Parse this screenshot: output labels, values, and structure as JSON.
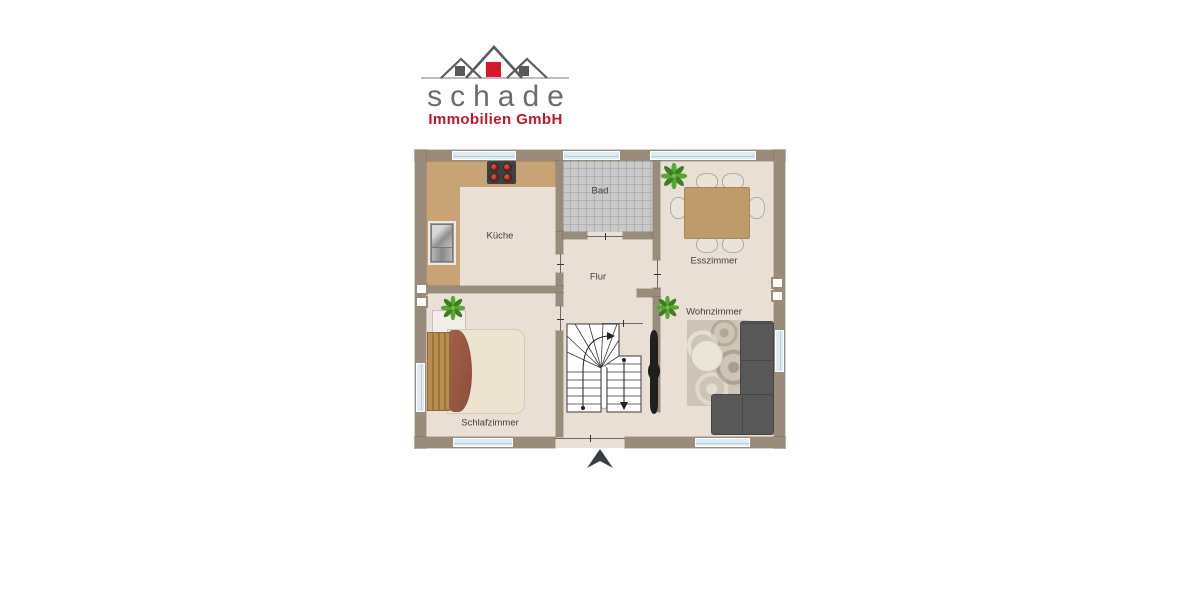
{
  "logo": {
    "brand": "schade",
    "subtitle": "Immobilien GmbH",
    "colors": {
      "brand_text": "#6b6c6f",
      "subtitle_text": "#c2172b",
      "roof_outline": "#5b5c5e",
      "red_square": "#d6182f",
      "gray_square": "#58595b"
    }
  },
  "plan": {
    "rooms": [
      {
        "id": "kueche",
        "label": "Küche",
        "furniture": [
          "kitchen-counter",
          "stove",
          "sink"
        ]
      },
      {
        "id": "bad",
        "label": "Bad",
        "furniture": [
          "tile-floor"
        ]
      },
      {
        "id": "esszimmer",
        "label": "Esszimmer",
        "furniture": [
          "dining-table",
          "six-chairs",
          "plant"
        ]
      },
      {
        "id": "flur",
        "label": "Flur",
        "furniture": []
      },
      {
        "id": "wohnzimmer",
        "label": "Wohnzimmer",
        "furniture": [
          "corner-sofa",
          "round-table",
          "rug",
          "plant",
          "dark-decor"
        ]
      },
      {
        "id": "schlafzimmer",
        "label": "Schlafzimmer",
        "furniture": [
          "double-bed",
          "dresser",
          "plant"
        ]
      }
    ],
    "features": [
      "u-shaped-staircase",
      "entrance-arrow",
      "chimney-blocks",
      "windows",
      "door-openings"
    ],
    "colors": {
      "wall": "#9a8c7b",
      "floor": "#eadfd5",
      "bathroom_tile": "#c9c9c9",
      "counter": "#c8a376",
      "window_glass": "#dcecf2",
      "sofa": "#585858",
      "dining_table": "#bf9a6a",
      "blanket": "#9a5a41",
      "plant_green": "#55a02e",
      "arrow": "#3a3d40"
    }
  }
}
